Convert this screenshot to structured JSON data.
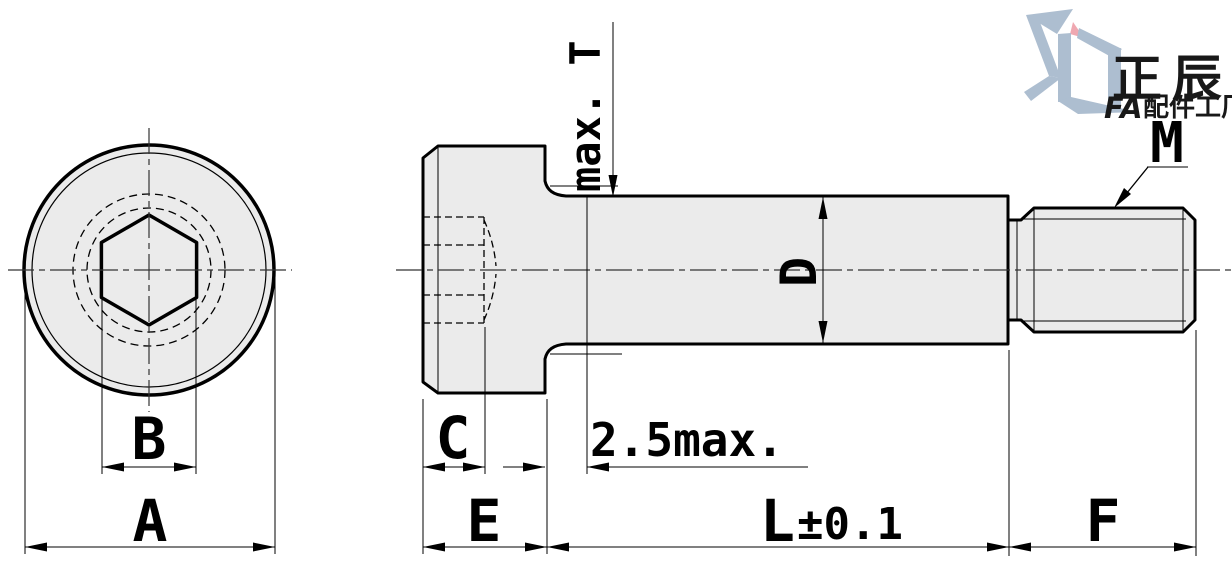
{
  "dimensions": {
    "head_diameter": "A",
    "hex_socket_width": "B",
    "socket_depth": "C",
    "shoulder_diameter": "D",
    "head_height": "E",
    "thread_length": "F",
    "shoulder_length": "L",
    "shoulder_length_tolerance": "±0.1",
    "incomplete_thread_length": "2.5max.",
    "fillet_height": "max. T",
    "thread_size": "M"
  },
  "logo": {
    "brand_cn": "正辰",
    "brand_prefix": "FA",
    "brand_suffix": "配件工厂"
  },
  "colors": {
    "part_fill": "#ebebeb",
    "line": "#000000",
    "centerline": "#333333",
    "logo_blue": "#a5b7cb",
    "logo_pink": "#ee9fa9"
  }
}
